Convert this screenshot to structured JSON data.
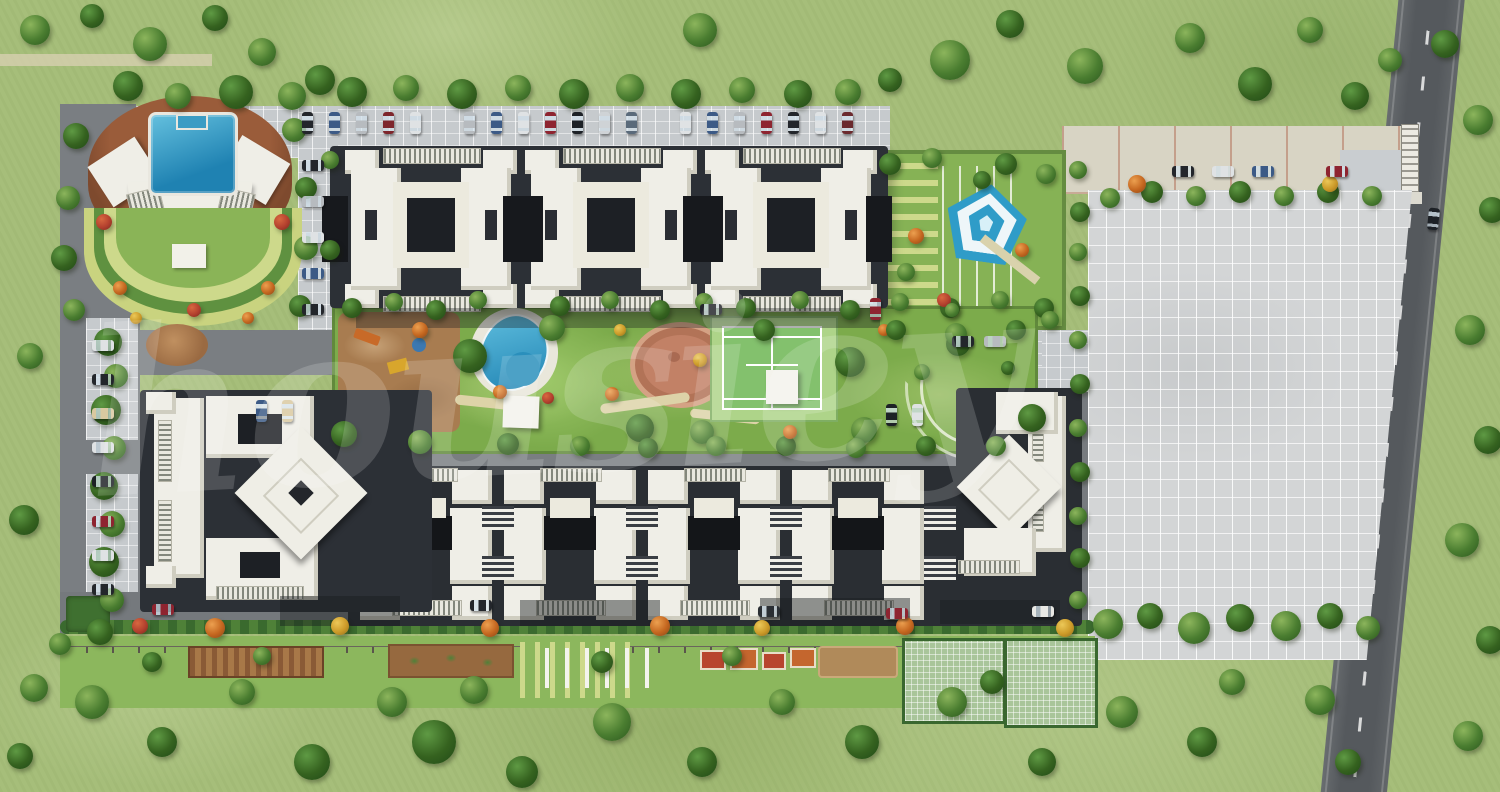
{
  "watermark": {
    "text": "housiey",
    "opacity": 0.16
  },
  "palette": {
    "grass": "#a6be7a",
    "lawn_bright": "#7cab4b",
    "lawn_clubhouse": "#8ab457",
    "lawn_stripe": "#cdd98b",
    "asphalt_perimeter_road": "#55595d",
    "asphalt_internal": "#7a7e82",
    "podium_dark": "#2c3036",
    "shadow_deep": "#17191d",
    "paver_grey": "#c6cacd",
    "paved_plot": "#d3d5d6",
    "buff_paving": "#d8d4c4",
    "buff_line_red": "#b06a52",
    "roof_white": "#efeee7",
    "roof_trim": "#cfcdc0",
    "pool_blue": "#3fa6cf",
    "pool_deep": "#1f82b2",
    "tennis_surround": "#aed489",
    "tennis_court": "#83c16d",
    "line_white": "#ffffff",
    "plaza_terracotta": "#c28166",
    "sand_play": "#a87c50",
    "deck_brown": "#8a5136",
    "pergola_brown": "#8a5a36",
    "tree_dark": "#35621f",
    "tree_mid": "#4a7d30",
    "flower_orange": "#c4661f",
    "flower_yellow": "#cc9a28",
    "flower_red": "#b3402e",
    "hedge_green": "#3f7030",
    "gate_white": "#eceae2",
    "marking_white": "#f0f0ea"
  },
  "scene": {
    "features": [
      {
        "name": "clubhouse-swimming-pool"
      },
      {
        "name": "clubhouse-fan-building"
      },
      {
        "name": "amphitheatre-lawn"
      },
      {
        "name": "top-tower-row"
      },
      {
        "name": "bottom-tower-row"
      },
      {
        "name": "cross-tower"
      },
      {
        "name": "kids-play-sand-area"
      },
      {
        "name": "leisure-pool"
      },
      {
        "name": "central-lawn"
      },
      {
        "name": "circular-plaza"
      },
      {
        "name": "tennis-court"
      },
      {
        "name": "pentagon-water-feature"
      },
      {
        "name": "striped-garden"
      },
      {
        "name": "open-paved-parking-plot"
      },
      {
        "name": "entrance-gate"
      },
      {
        "name": "perimeter-road"
      },
      {
        "name": "surface-parking-rows"
      },
      {
        "name": "box-courts"
      },
      {
        "name": "sand-pit"
      },
      {
        "name": "pergola-seating"
      },
      {
        "name": "open-lawn-with-trees"
      }
    ]
  }
}
